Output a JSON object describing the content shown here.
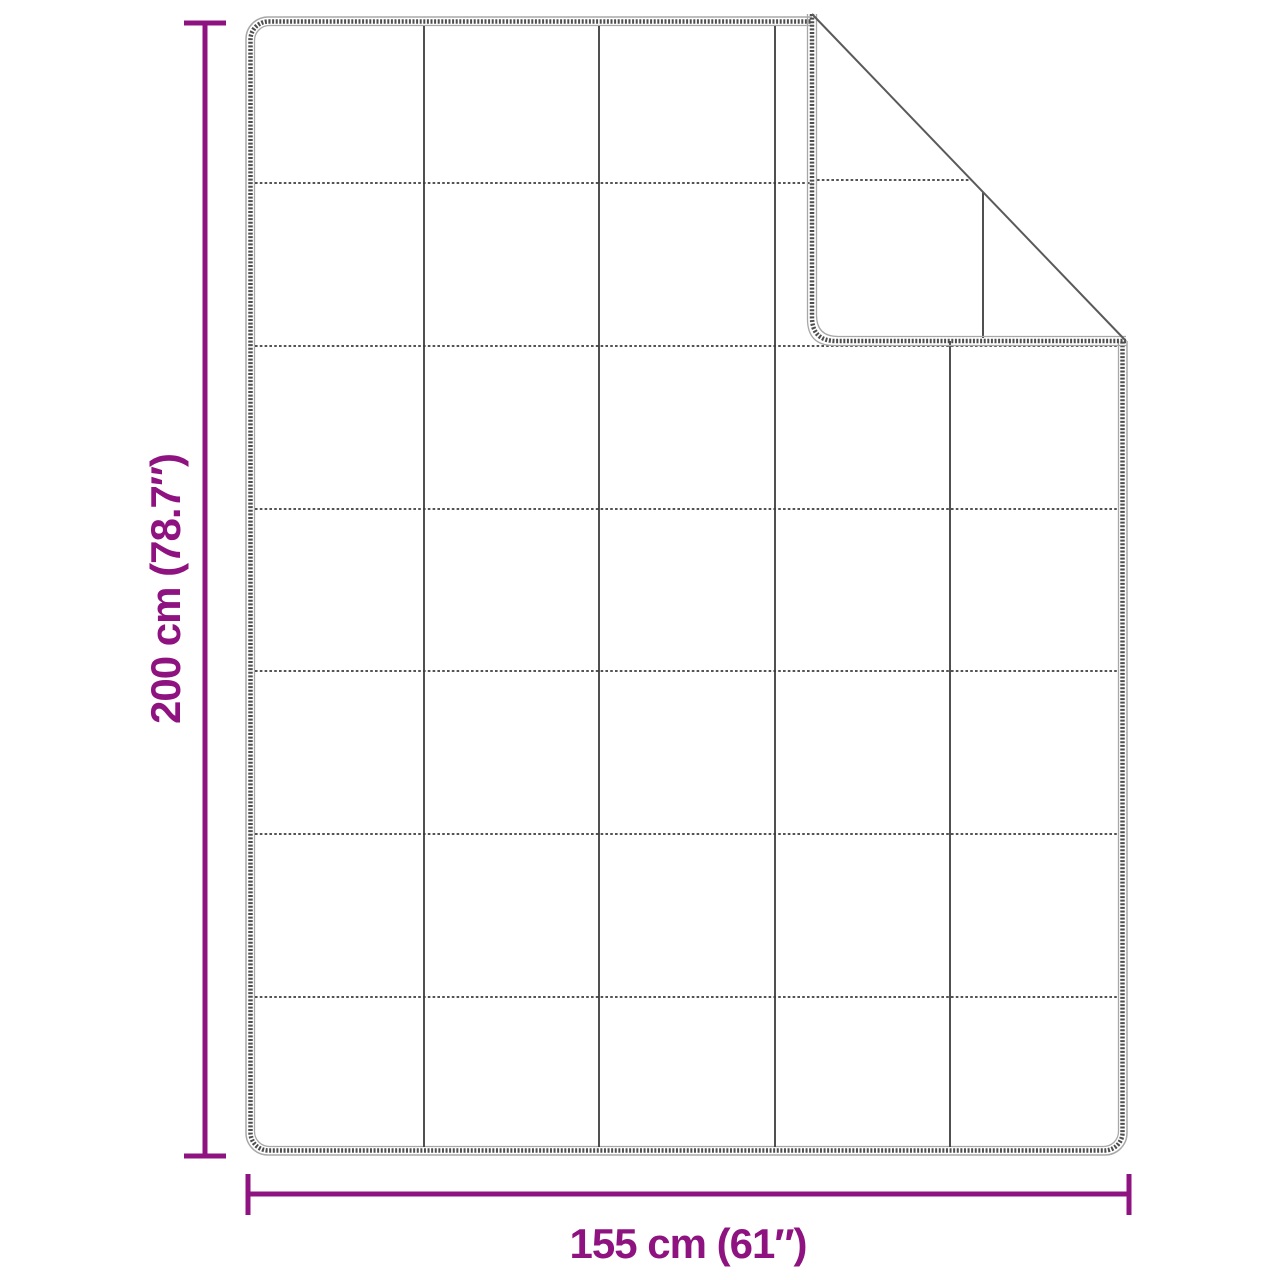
{
  "diagram": {
    "subject": "quilted-blanket-top-view-with-folded-corner",
    "quilt_grid": {
      "columns": 5,
      "rows": 7
    },
    "dimensions": {
      "height": {
        "label": "200 cm (78.7″)"
      },
      "width": {
        "label": "155 cm (61″)"
      }
    }
  },
  "colors": {
    "accent": "#8e1381",
    "edge_dark": "#4e4e4e",
    "edge_light": "#a8a8a8",
    "quilt_line": "#3d3d3d",
    "crease": "#5a5a5a",
    "background": "#ffffff"
  }
}
